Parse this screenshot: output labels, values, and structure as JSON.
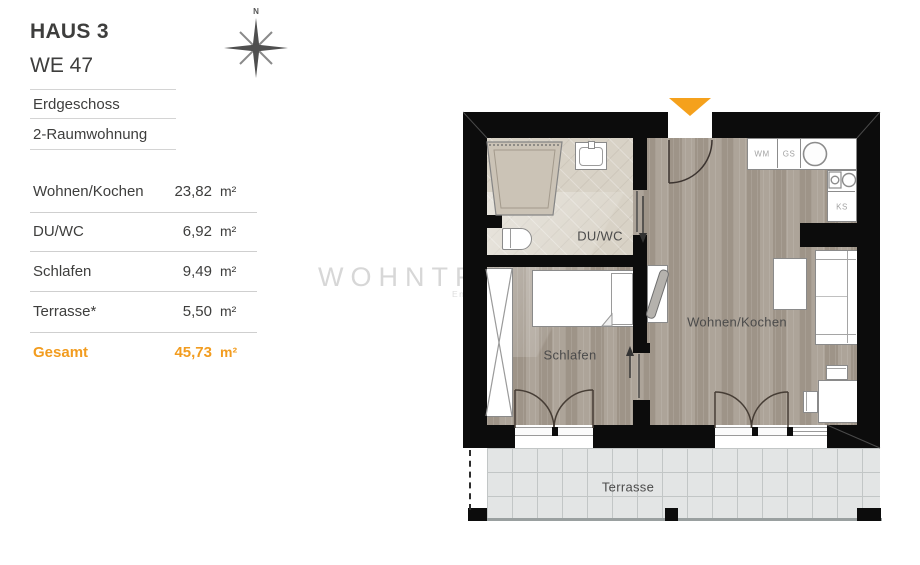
{
  "header": {
    "title": "HAUS 3",
    "subtitle": "WE 47"
  },
  "unit_info": {
    "floor": "Erdgeschoss",
    "type": "2-Raumwohnung"
  },
  "area_table": {
    "rows": [
      {
        "label": "Wohnen/Kochen",
        "value": "23,82",
        "unit": "m²"
      },
      {
        "label": "DU/WC",
        "value": "6,92",
        "unit": "m²"
      },
      {
        "label": "Schlafen",
        "value": "9,49",
        "unit": "m²"
      },
      {
        "label": "Terrasse*",
        "value": "5,50",
        "unit": "m²"
      }
    ],
    "total": {
      "label": "Gesamt",
      "value": "45,73",
      "unit": "m²"
    }
  },
  "compass": {
    "north_label": "N"
  },
  "watermark": {
    "brand": "WOHNTRAUMFINDER",
    "tagline": "Endlich zuhause"
  },
  "floorplan": {
    "room_labels": {
      "bathroom": "DU/WC",
      "bedroom": "Schlafen",
      "living_kitchen": "Wohnen/Kochen",
      "terrace": "Terrasse"
    },
    "appliances": {
      "washing_machine": "WM",
      "dishwasher": "GS",
      "fridge": "KS"
    }
  },
  "colors": {
    "accent": "#f5a11c",
    "wall": "#0c0c0c",
    "wood_floor": "#a79d91",
    "bath_floor": "#d8d2c6",
    "terrace_tile": "#e3e5e5",
    "text": "#3e3e3d",
    "watermark": "#d7d7d7"
  }
}
